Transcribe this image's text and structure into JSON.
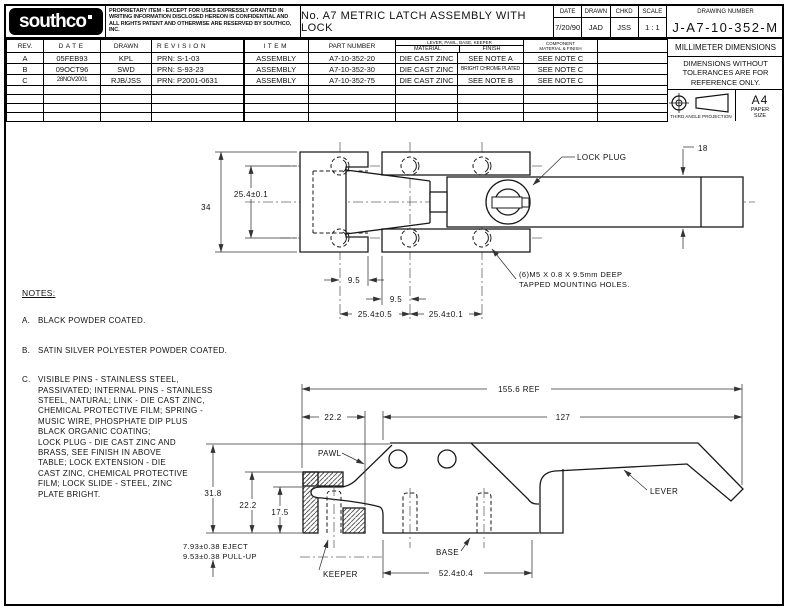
{
  "title_block": {
    "logo": "southco",
    "proprietary": "PROPRIETARY ITEM - EXCEPT FOR USES EXPRESSLY GRANTED IN WRITING INFORMATION DISCLOSED HEREON IS CONFIDENTIAL AND ALL RIGHTS PATENT AND OTHERWISE ARE RESERVED BY SOUTHCO, INC.",
    "title": "No. A7 METRIC LATCH ASSEMBLY WITH LOCK",
    "date_label": "DATE",
    "date": "7/20/90",
    "drawn_label": "DRAWN",
    "drawn": "JAD",
    "chkd_label": "CHKD",
    "chkd": "JSS",
    "scale_label": "SCALE",
    "scale": "1 : 1",
    "drawing_number_label": "DRAWING NUMBER",
    "drawing_number": "J-A7-10-352-M"
  },
  "revision_table": {
    "headers": {
      "rev": "REV.",
      "date": "DATE",
      "drawn": "DRAWN",
      "revision": "REVISION",
      "item": "ITEM",
      "part_number": "PART NUMBER",
      "group": "LEVER, PAWL, BASE, KEEPER",
      "material": "MATERIAL",
      "finish": "FINISH",
      "component_1": "COMPONENT",
      "component_2": "MATERIAL & FINISH"
    },
    "rows": [
      {
        "rev": "A",
        "date": "05FEB93",
        "drawn": "KPL",
        "revision": "PRN: S-1-03",
        "item": "ASSEMBLY",
        "part_number": "A7-10-352-20",
        "material": "DIE CAST ZINC",
        "finish": "SEE NOTE A",
        "component": "SEE NOTE C"
      },
      {
        "rev": "B",
        "date": "09OCT96",
        "drawn": "SWD",
        "revision": "PRN: S-93-23",
        "item": "ASSEMBLY",
        "part_number": "A7-10-352-30",
        "material": "DIE CAST ZINC",
        "finish": "BRIGHT CHROME PLATED",
        "component": "SEE NOTE C"
      },
      {
        "rev": "C",
        "date": "28NOV2001",
        "drawn": "RJB/JSS",
        "revision": "PRN: P2001-0631",
        "item": "ASSEMBLY",
        "part_number": "A7-10-352-75",
        "material": "DIE CAST ZINC",
        "finish": "SEE NOTE B",
        "component": "SEE NOTE C"
      }
    ]
  },
  "info_box": {
    "millimeter": "MILLIMETER DIMENSIONS",
    "tolerance_note": "DIMENSIONS WITHOUT\nTOLERANCES ARE FOR\nREFERENCE ONLY.",
    "projection": "THIRD ANGLE PROJECTION",
    "paper": "A4",
    "paper_sub": "PAPER\nSIZE"
  },
  "notes": {
    "heading": "NOTES:",
    "items": [
      {
        "label": "A.",
        "text": "BLACK POWDER COATED."
      },
      {
        "label": "B.",
        "text": "SATIN SILVER POLYESTER POWDER COATED."
      },
      {
        "label": "C.",
        "text": "VISIBLE PINS - STAINLESS STEEL,\nPASSIVATED; INTERNAL PINS - STAINLESS\nSTEEL, NATURAL; LINK - DIE CAST ZINC,\nCHEMICAL PROTECTIVE FILM; SPRING -\nMUSIC WIRE, PHOSPHATE DIP PLUS\nBLACK ORGANIC COATING;\nLOCK PLUG - DIE CAST ZINC AND\nBRASS, SEE FINISH IN ABOVE\nTABLE; LOCK EXTENSION - DIE\nCAST ZINC, CHEMICAL PROTECTIVE\nFILM; LOCK SLIDE - STEEL, ZINC\nPLATE BRIGHT."
      }
    ]
  },
  "top_view": {
    "dims": {
      "height": "34",
      "hole_row_span": "25.4±0.1",
      "edge_offset_1": "9.5",
      "edge_offset_2": "9.5",
      "hole_pitch_1": "25.4±0.5",
      "hole_pitch_2": "25.4±0.1",
      "lever_width": "18"
    },
    "labels": {
      "lock_plug": "LOCK PLUG",
      "mounting_holes_1": "(6)M5 X 0.8 X 9.5mm DEEP",
      "mounting_holes_2": "TAPPED MOUNTING HOLES."
    }
  },
  "side_view": {
    "dims": {
      "overall_length": "155.6 REF",
      "lever_length": "127",
      "keeper_depth": "22.2",
      "overall_height": "31.8",
      "keeper_height": "22.2",
      "slot_height": "17.5",
      "eject": "7.93±0.38 EJECT",
      "pull_up": "9.53±0.38 PULL-UP",
      "base_length": "52.4±0.4"
    },
    "labels": {
      "pawl": "PAWL",
      "keeper": "KEEPER",
      "base": "BASE",
      "lever": "LEVER"
    }
  }
}
